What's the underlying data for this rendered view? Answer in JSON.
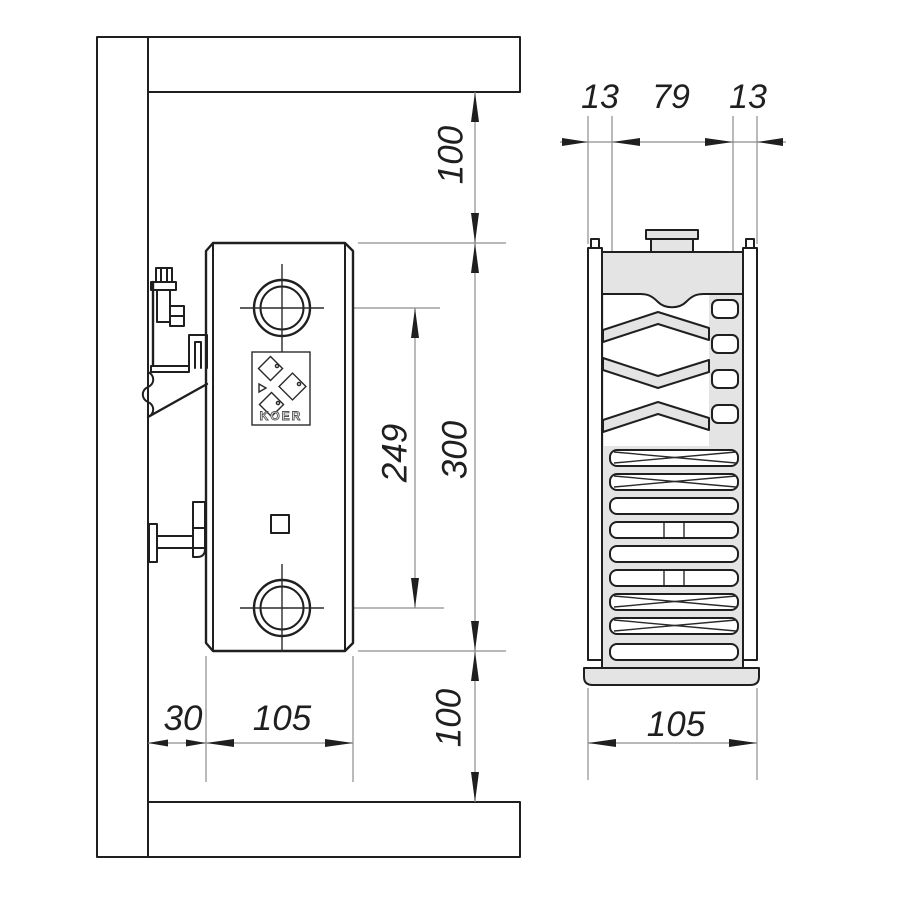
{
  "side_view": {
    "labels": {
      "ceiling_gap": "100",
      "port_spacing": "249",
      "height": "300",
      "floor_gap": "100",
      "wall_offset": "30",
      "depth": "105"
    },
    "logo_text": "KOER"
  },
  "section_view": {
    "labels": {
      "left_panel": "13",
      "core": "79",
      "right_panel": "13",
      "total_depth": "105"
    }
  },
  "colors": {
    "line": "#1f1f1f",
    "dim_line": "#8d8d8d",
    "fill_gray": "#e4e4e4",
    "background": "#ffffff"
  }
}
